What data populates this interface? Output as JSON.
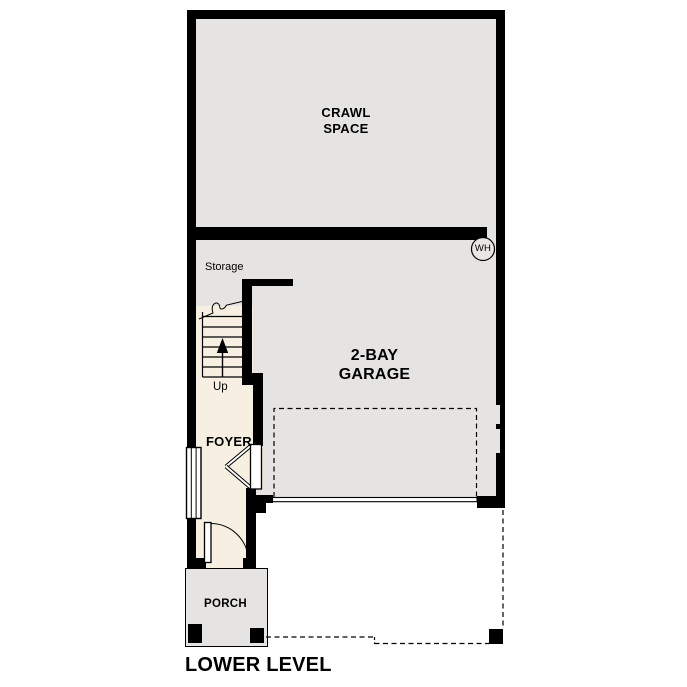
{
  "plan_title": "LOWER LEVEL",
  "rooms": {
    "crawl_space": "CRAWL SPACE",
    "garage": "2-BAY GARAGE",
    "storage": "Storage",
    "foyer": "FOYER",
    "porch": "PORCH"
  },
  "stairs": {
    "direction": "Up"
  },
  "fixtures": {
    "water_heater_abbr": "WH"
  },
  "colors": {
    "wall": "#000000",
    "floor_gray": "#e5e4e2",
    "floor_cream": "#f7f0e2",
    "line": "#000000",
    "background": "#ffffff"
  }
}
